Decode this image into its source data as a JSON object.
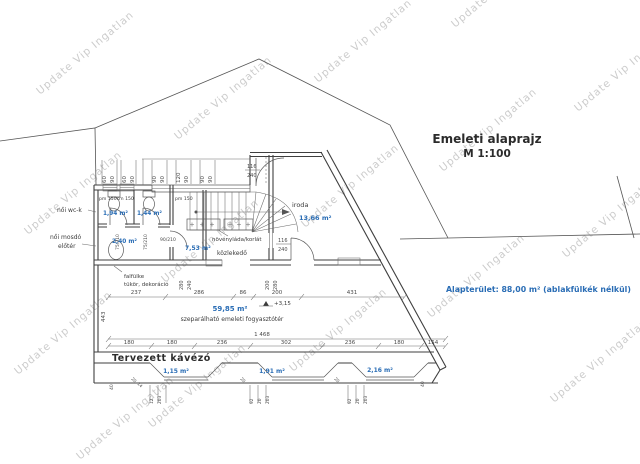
{
  "watermark": {
    "text": "Update Vip Ingatlan"
  },
  "title": {
    "line1": "Emeleti alaprajz",
    "line2": "M 1:100"
  },
  "summary": {
    "text": "Alapterület: 88,00 m² (ablakfülkék nélkül)",
    "color": "#2a6db5"
  },
  "labels": {
    "wc_group": "női wc-k",
    "washroom1": "női mosdó",
    "washroom2": "előtér",
    "corridor": "közlekedő",
    "office": "iroda",
    "planter": "növényláda/korlát",
    "wall_niche1": "falfülke",
    "wall_niche2": "tükör, dekoráció",
    "main_room": "szeparálható emeleti fogyasztótér",
    "cafe": "Tervezett kávézó",
    "level": "+3,15",
    "parapet_left": "pm 150cm 150",
    "parapet_right": "pm 150"
  },
  "areas": {
    "wc1": "1,94 m²",
    "wc2": "1,44 m²",
    "anteroom": "2,40 m²",
    "corridor": "7,53 m²",
    "office": "13,66 m²",
    "main": "59,85 m²",
    "niche1": "1,15 m²",
    "niche2": "1,91 m²",
    "niche3": "2,16 m²"
  },
  "dims": {
    "top_windows": [
      "60",
      "90",
      "60",
      "90",
      "90",
      "90",
      "120",
      "90",
      "90",
      "90"
    ],
    "window_116_w": "116",
    "window_116_h": "240",
    "doors": [
      "75/210",
      "75/210",
      "90/210"
    ],
    "niche_depth": [
      "280",
      "240",
      "200",
      "280"
    ],
    "width_segments": [
      "237",
      "286",
      "86",
      "200",
      "431"
    ],
    "total_width": "1 468",
    "room_depth": "443",
    "bottom_segments": [
      "180",
      "180",
      "236",
      "302",
      "236",
      "180",
      "154"
    ],
    "niche1_small": [
      "12",
      "203"
    ],
    "niche2_small": [
      "92",
      "20",
      "203"
    ],
    "niche3_small": [
      "92",
      "20",
      "203"
    ],
    "reveal": [
      "20",
      "14"
    ],
    "forty": "40"
  }
}
